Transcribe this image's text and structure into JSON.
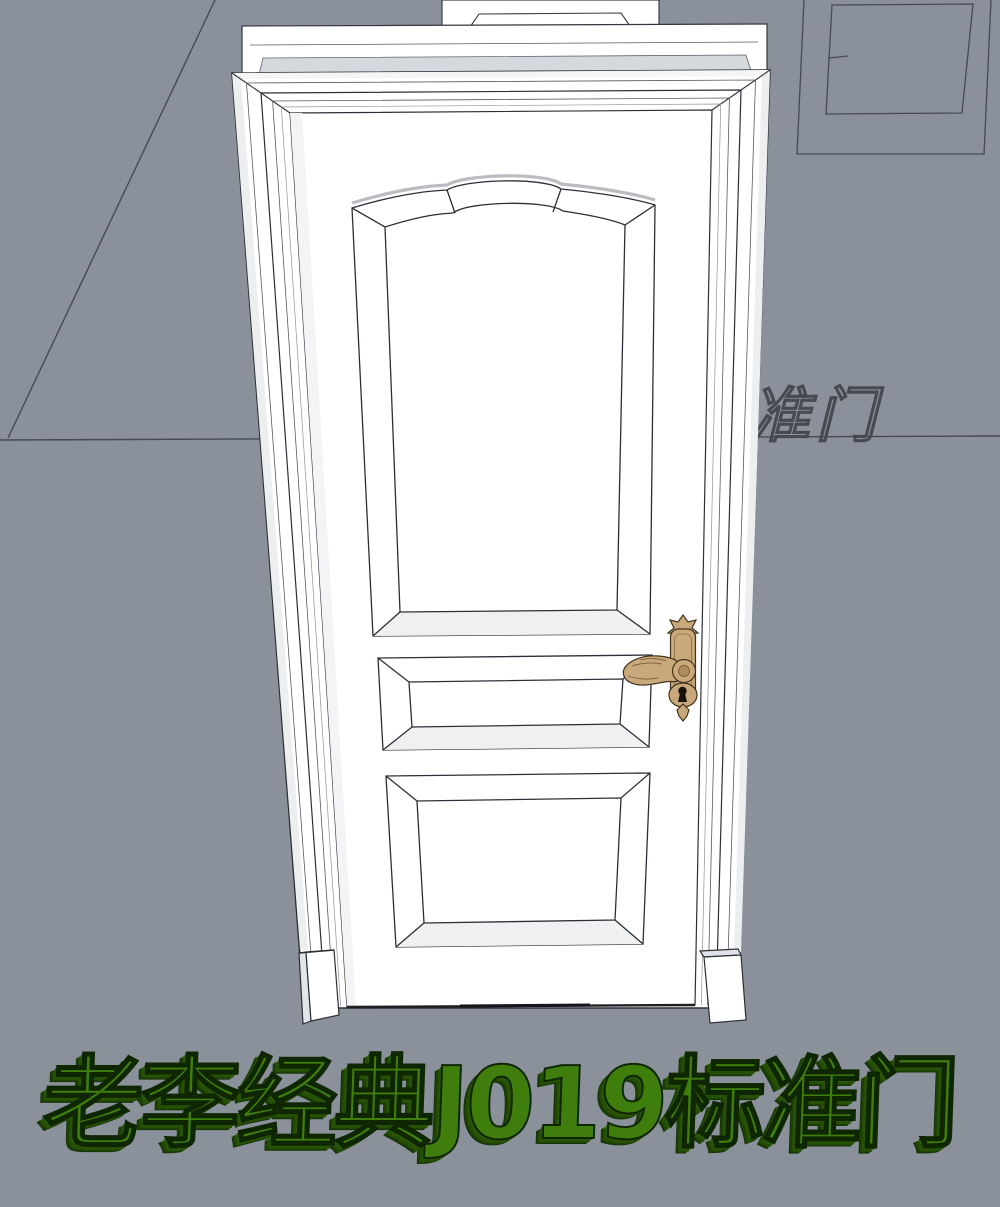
{
  "viewport": {
    "kind": "3d-door-model-preview",
    "model_title": "老李经典J019标准门",
    "background_text": "准门",
    "colors": {
      "background": "#8a919b",
      "outline": "#2c3036",
      "wireframe_line": "#464b52",
      "door_white": "#ffffff",
      "trim_top_face": "#d5d9dd",
      "handle_brass": "#c9a97b",
      "handle_outline": "#42331c",
      "title_green": "#3f7e0d",
      "title_extrude_green": "#255006"
    }
  }
}
